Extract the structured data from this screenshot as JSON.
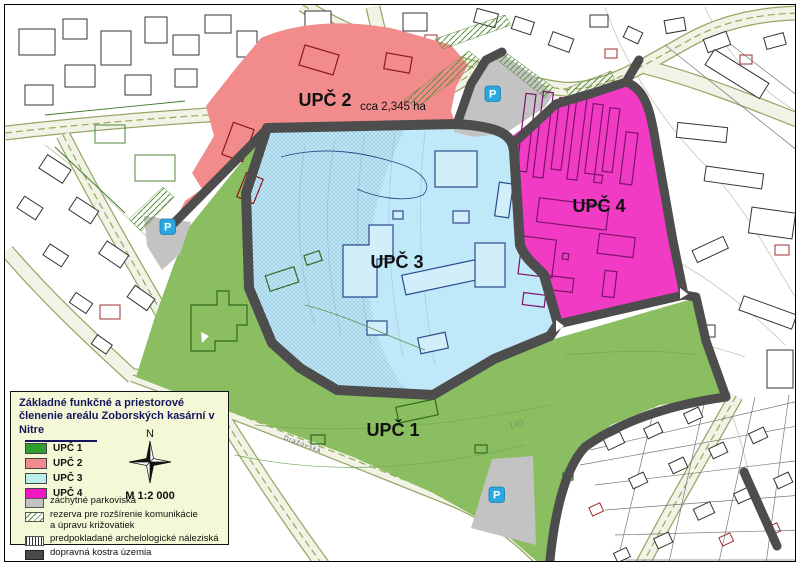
{
  "map": {
    "labels": {
      "zone1": "UPČ 1",
      "zone2": "UPČ 2",
      "zone3": "UPČ 3",
      "zone4": "UPČ 4",
      "area_note": "cca 2,345 ha",
      "parking_symbol": "P",
      "street_name": "Dražovská",
      "contour_label": "140"
    },
    "colors": {
      "zone1": "#8abe60",
      "zone2": "#f28c8c",
      "zone3": "#bfe9f8",
      "zone4": "#f23bc4",
      "parking_area": "#c3c3c3",
      "road": "#4d4d4d",
      "parking_icon_bg": "#2aa7df"
    }
  },
  "legend": {
    "title_line1": "Základné funkčné a priestorové",
    "title_line2": "členenie areálu Zoborských kasární v Nitre",
    "compass_label": "N",
    "scale_label": "M 1:2 000",
    "zones": [
      {
        "label": "UPČ 1",
        "color": "#2f9e2f"
      },
      {
        "label": "UPČ 2",
        "color": "#f28c8c"
      },
      {
        "label": "UPČ 3",
        "color": "#b9f0ea"
      },
      {
        "label": "UPČ 4",
        "color": "#f318c3"
      }
    ],
    "items": [
      {
        "label": "záchytné parkoviská"
      },
      {
        "label": "rezerva pre rozšírenie komunikácie",
        "label2": "a úpravu križovatiek"
      },
      {
        "label": "predpokladané archelologické náleziská"
      },
      {
        "label": "dopravná kostra územia"
      }
    ]
  }
}
